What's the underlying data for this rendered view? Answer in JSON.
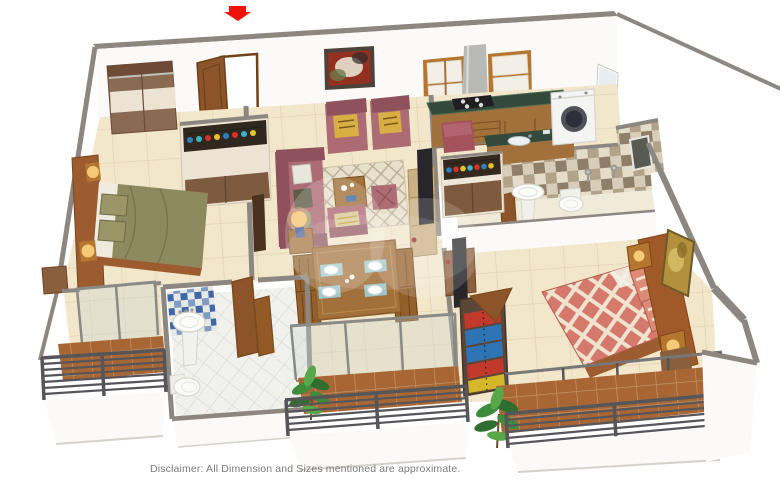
{
  "meta": {
    "kind": "3d-isometric-floor-plan",
    "description": "3D rendered 2BHK apartment floor plan, viewed from above at an angle"
  },
  "entrance": {
    "marker": "red-down-arrow"
  },
  "disclaimer": "Disclaimer: All Dimension and Sizes mentioned are approximate.",
  "watermark": {
    "present": true,
    "style": "faint translucent white blob over center"
  },
  "palette": {
    "wall_cap": "#8d8781",
    "wall_face": "#fbfaf8",
    "floor": "#f2e6cb",
    "floor_grout": "#e3d3b2",
    "deck": "#a96635",
    "deck_grout": "#c89b6d",
    "white_floor": "#f1f1ed",
    "white_floor_grout": "#d9d9d2",
    "sofa": "#ad6b73",
    "sofa_dark": "#8f525c",
    "cushion_yellow": "#d9af45",
    "olive": "#8d8a5f",
    "olive_dark": "#6e6a48",
    "wood": "#b5762f",
    "wood_face": "#a2703a",
    "wood_dark": "#7b4d22",
    "cream_panel": "#ece3d3",
    "cabinet_brown": "#7e5a3e",
    "granite": "#32493b",
    "chimney_gray": "#b9b9b5",
    "appliance_white": "#f4f4f2",
    "tv_black": "#27272b",
    "bed_salmon": "#d5796c",
    "bed_cream": "#f0e4d0",
    "headboard": "#9c5c30",
    "railing": "#55555a",
    "glass": "#cdd6d2",
    "plant": "#3c8c3c",
    "plant_dark": "#2f6e30",
    "plant_light": "#58a84a",
    "lamp_glow": "#f4c977",
    "lamp_base_blue": "#4f5f9a",
    "red_arrow": "#ee1208",
    "door_wood": "#8b5429",
    "door_frame": "#6f4218",
    "tile_blue": "#3e68a8",
    "tile_a": "#b3a28a",
    "tile_b": "#e5dcc9",
    "tile_c": "#8f7e68",
    "tile_d": "#d8cdb8",
    "art_red": "#93301f",
    "art_gold": "#b3913c",
    "placemat": "#9fc8cc",
    "text_gray": "#7b7b7b"
  },
  "bottle_colors": [
    "#2f7fbe",
    "#d93025",
    "#e8c227",
    "#38b6c9",
    "#d93025",
    "#2f7fbe",
    "#e8c227",
    "#d93025"
  ],
  "clothes_colors": [
    "#c0392b",
    "#2e74b5",
    "#2e74b5",
    "#c0392b",
    "#d4b82a"
  ],
  "rooms": [
    {
      "name": "bedroom-1",
      "furniture": [
        "two-door wardrobe",
        "double bed with olive green bedding",
        "wall headboard panel with two lit lamps",
        "bedside unit",
        "display rack with bottles",
        "dark door panel",
        "sliding door to balcony"
      ]
    },
    {
      "name": "living-room",
      "furniture": [
        "entrance door (open) with red arrow marker",
        "abstract wall painting",
        "two accent armchairs with yellow cushions",
        "three-seater maroon sofa with cushions",
        "single maroon chair with striped cushion",
        "tufted ottoman",
        "red pouf",
        "patterned rug",
        "wooden coffee table with decor",
        "side table with lit lamp (blue base)",
        "TV unit with flat TV"
      ]
    },
    {
      "name": "dining-area",
      "furniture": [
        "4-seater wooden dining table",
        "4 white plates on teal placemats",
        "4 wooden chairs",
        "sliding glass doors to balcony"
      ]
    },
    {
      "name": "kitchen",
      "furniture": [
        "wall cabinets (wood + white shutters)",
        "chimney hood",
        "green granite counter with 4-burner gas stove",
        "drawer unit",
        "parallel counter with sink",
        "washing machine (front load)",
        "window",
        "crockery unit with colored bottles"
      ]
    },
    {
      "name": "bathroom-1",
      "furniture": [
        "brown-beige checker tiled wall",
        "pedestal wash basin",
        "wall-hung toilet",
        "shower mixers",
        "wooden door",
        "dark window on tiled wall"
      ]
    },
    {
      "name": "bathroom-2",
      "furniture": [
        "blue patterned tile wall",
        "pedestal wash basin",
        "toilet",
        "white diagonal tiled floor",
        "wooden double door"
      ]
    },
    {
      "name": "master-bedroom",
      "furniture": [
        "double bed with salmon-cream diamond quilt",
        "two patterned pillows",
        "headboard panel with two cube lamps",
        "golden abstract wall art",
        "TV cabinet with flat TV",
        "open wardrobe with folded colorful clothes",
        "nightstand"
      ]
    },
    {
      "name": "balcony-left",
      "furniture": [
        "wooden deck tiles",
        "metal bar railing",
        "sliding glass door"
      ]
    },
    {
      "name": "balcony-center",
      "furniture": [
        "wooden deck tiles",
        "metal bar railing",
        "sliding glass doors",
        "potted plant"
      ]
    },
    {
      "name": "balcony-right",
      "furniture": [
        "wooden deck tiles",
        "metal bar railing",
        "potted plant",
        "glass partition posts"
      ]
    }
  ]
}
